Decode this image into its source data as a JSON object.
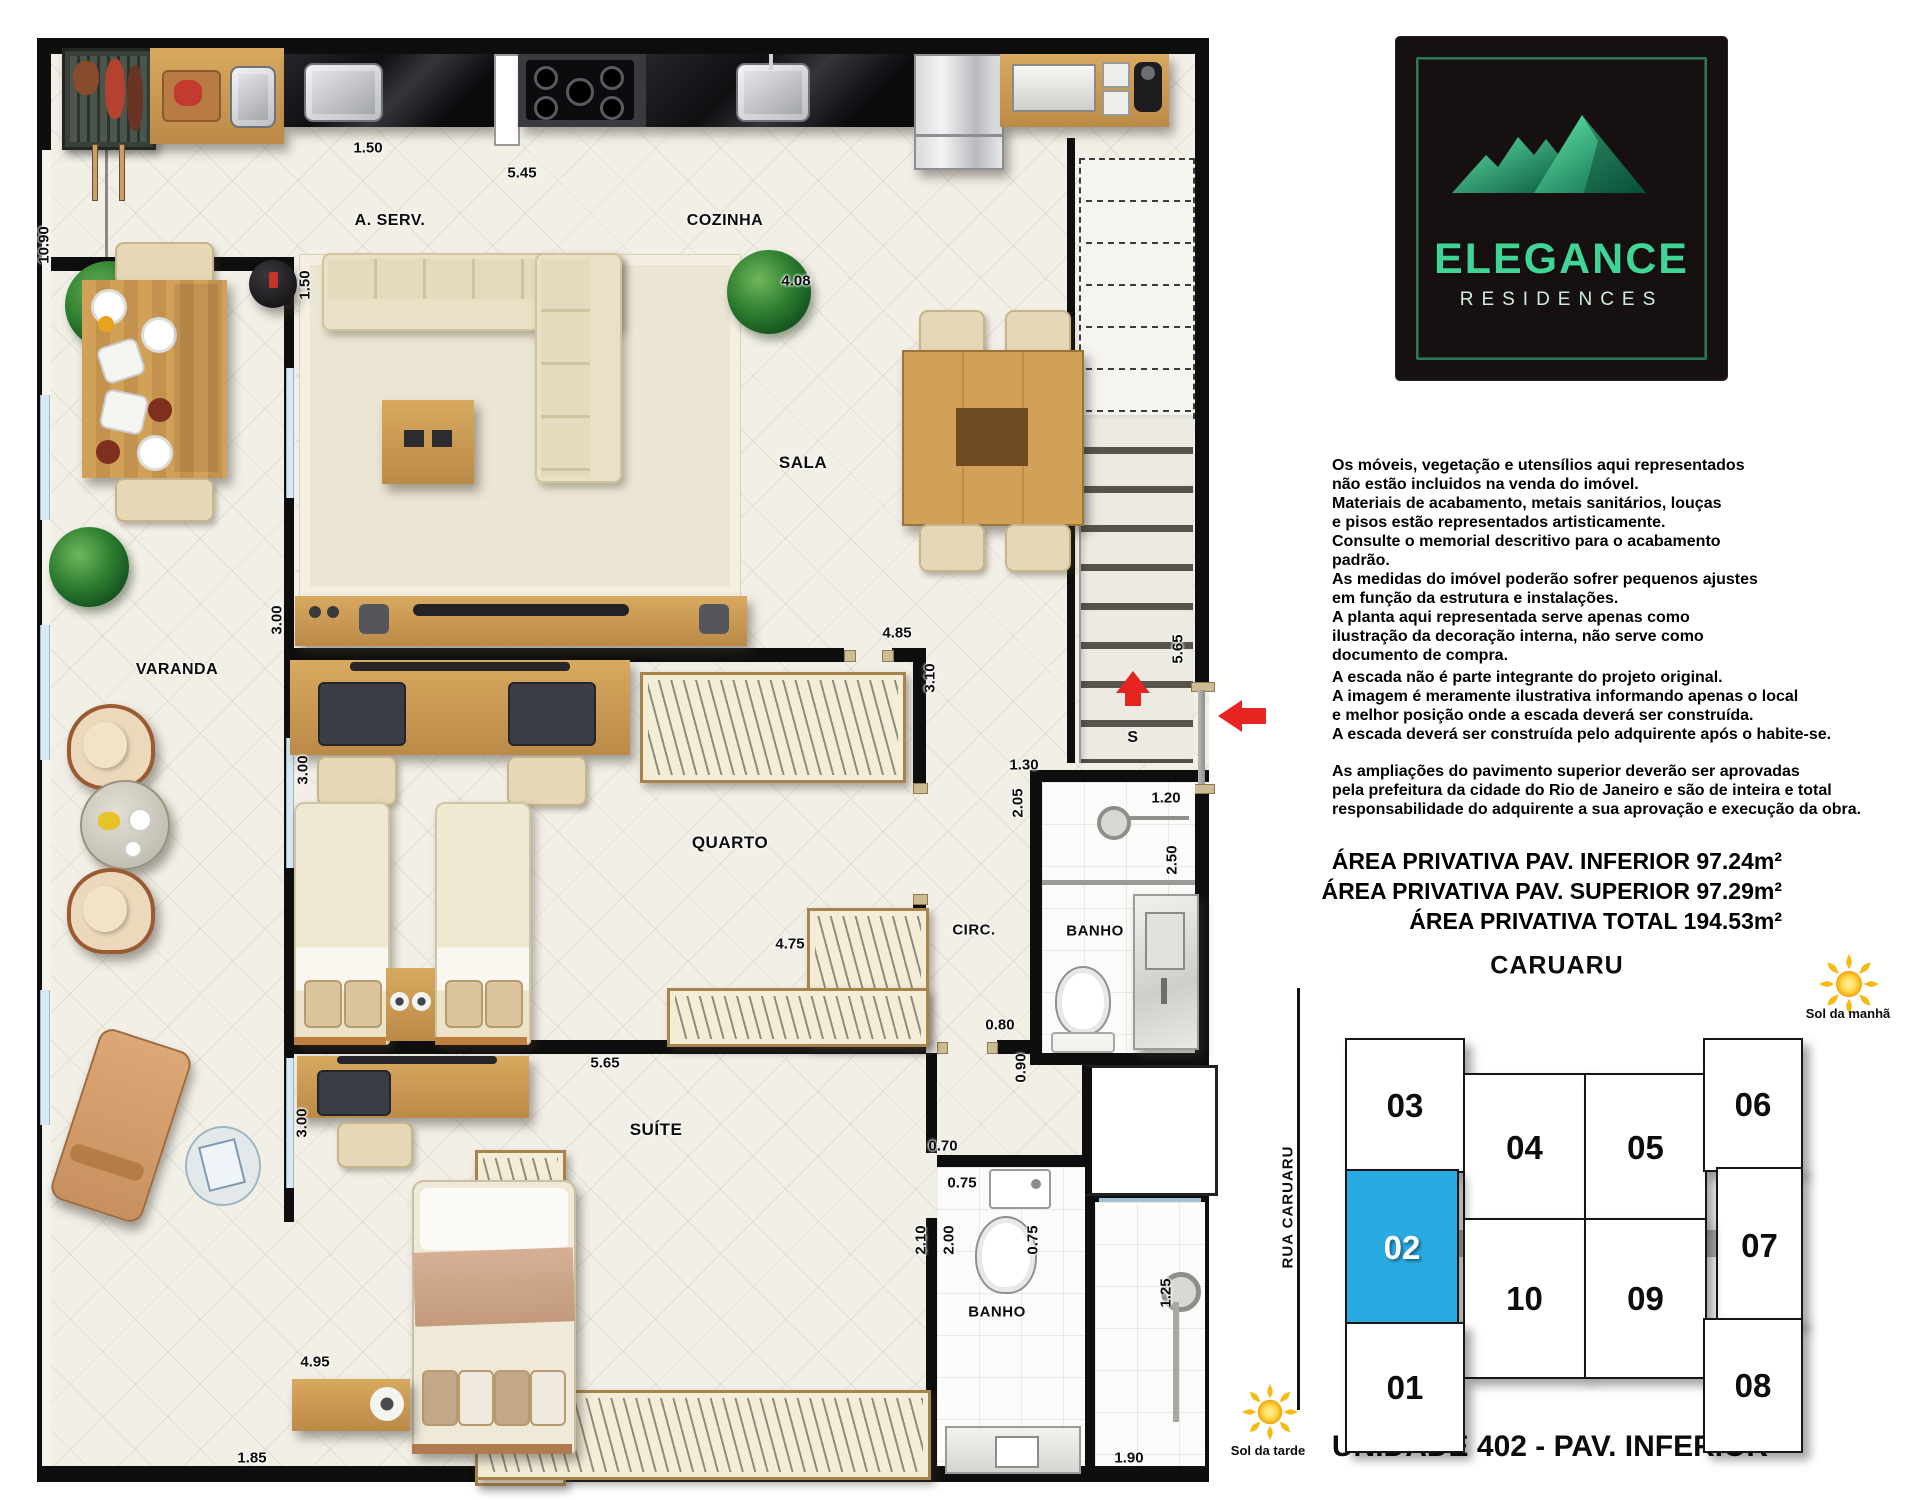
{
  "logo": {
    "title": "ELEGANCE",
    "subtitle": "RESIDENCES"
  },
  "plan": {
    "rooms": {
      "a_serv": "A. SERV.",
      "cozinha": "COZINHA",
      "sala": "SALA",
      "varanda": "VARANDA",
      "quarto": "QUARTO",
      "circ": "CIRC.",
      "banho_superior": "BANHO",
      "suite": "SUÍTE",
      "banho_suite": "BANHO",
      "stairs_direction": "S"
    },
    "dims": {
      "total_left": "10.90",
      "aserv_bancada": "1.50",
      "cozinha_bancada": "5.45",
      "aserv_width": "1.50",
      "sala_top": "4.08",
      "sala_rack": "3.00",
      "quarto_top": "4.85",
      "quarto_right": "3.10",
      "escada": "5.65",
      "banho1_top": "1.30",
      "banho1_left": "2.05",
      "banho1_inner_top": "1.20",
      "banho1_right": "2.50",
      "quarto_left": "3.00",
      "quarto_closet": "4.75",
      "circ_bottom": "0.80",
      "circ_door": "0.90",
      "suite_top": "5.65",
      "suite_left": "3.00",
      "suite_door": "0.70",
      "banho2_sink": "0.75",
      "banho2_left_a": "2.10",
      "banho2_left_b": "2.00",
      "banho2_inner": "0.75",
      "banho2_right": "1.25",
      "suite_bed_wall": "4.95",
      "varanda_bottom": "1.85",
      "banho2_bottom": "1.90"
    }
  },
  "notes": {
    "p1": "Os móveis, vegetação e utensílios aqui representados\nnão estão incluidos na venda do imóvel.\nMateriais de acabamento, metais sanitários, louças\ne pisos estão representados artisticamente.\nConsulte o memorial descritivo para o acabamento\npadrão.\nAs medidas do imóvel poderão sofrer pequenos ajustes\nem função da estrutura e instalações.\nA planta aqui representada serve apenas como\nilustração da decoração interna, não serve como\ndocumento de compra.",
    "p2": "A escada não é parte integrante do projeto original.\nA imagem é meramente ilustrativa informando apenas o local\ne melhor posição onde a escada deverá ser construída.\nA escada deverá ser construída pelo adquirente após o habite-se.",
    "p3": "As ampliações do pavimento superior deverão ser aprovadas\npela prefeitura da cidade do Rio de Janeiro e são de inteira e total\nresponsabilidade do adquirente a sua aprovação e execução da obra."
  },
  "areas": {
    "inferior": "ÁREA PRIVATIVA PAV. INFERIOR 97.24m²",
    "superior": "ÁREA PRIVATIVA PAV. SUPERIOR 97.29m²",
    "total": "ÁREA PRIVATIVA TOTAL 194.53m²"
  },
  "keyplan": {
    "street": "CARUARU",
    "street_side": "RUA CARUARU",
    "sun_morning": "Sol da manhã",
    "sun_afternoon": "Sol da tarde",
    "highlighted": "02",
    "highlight_color": "#29abe2",
    "units": {
      "u01": "01",
      "u02": "02",
      "u03": "03",
      "u04": "04",
      "u05": "05",
      "u06": "06",
      "u07": "07",
      "u08": "08",
      "u09": "09",
      "u10": "10"
    }
  },
  "footer": {
    "caption": "UNIDADE 402 - PAV. INFERIOR"
  }
}
